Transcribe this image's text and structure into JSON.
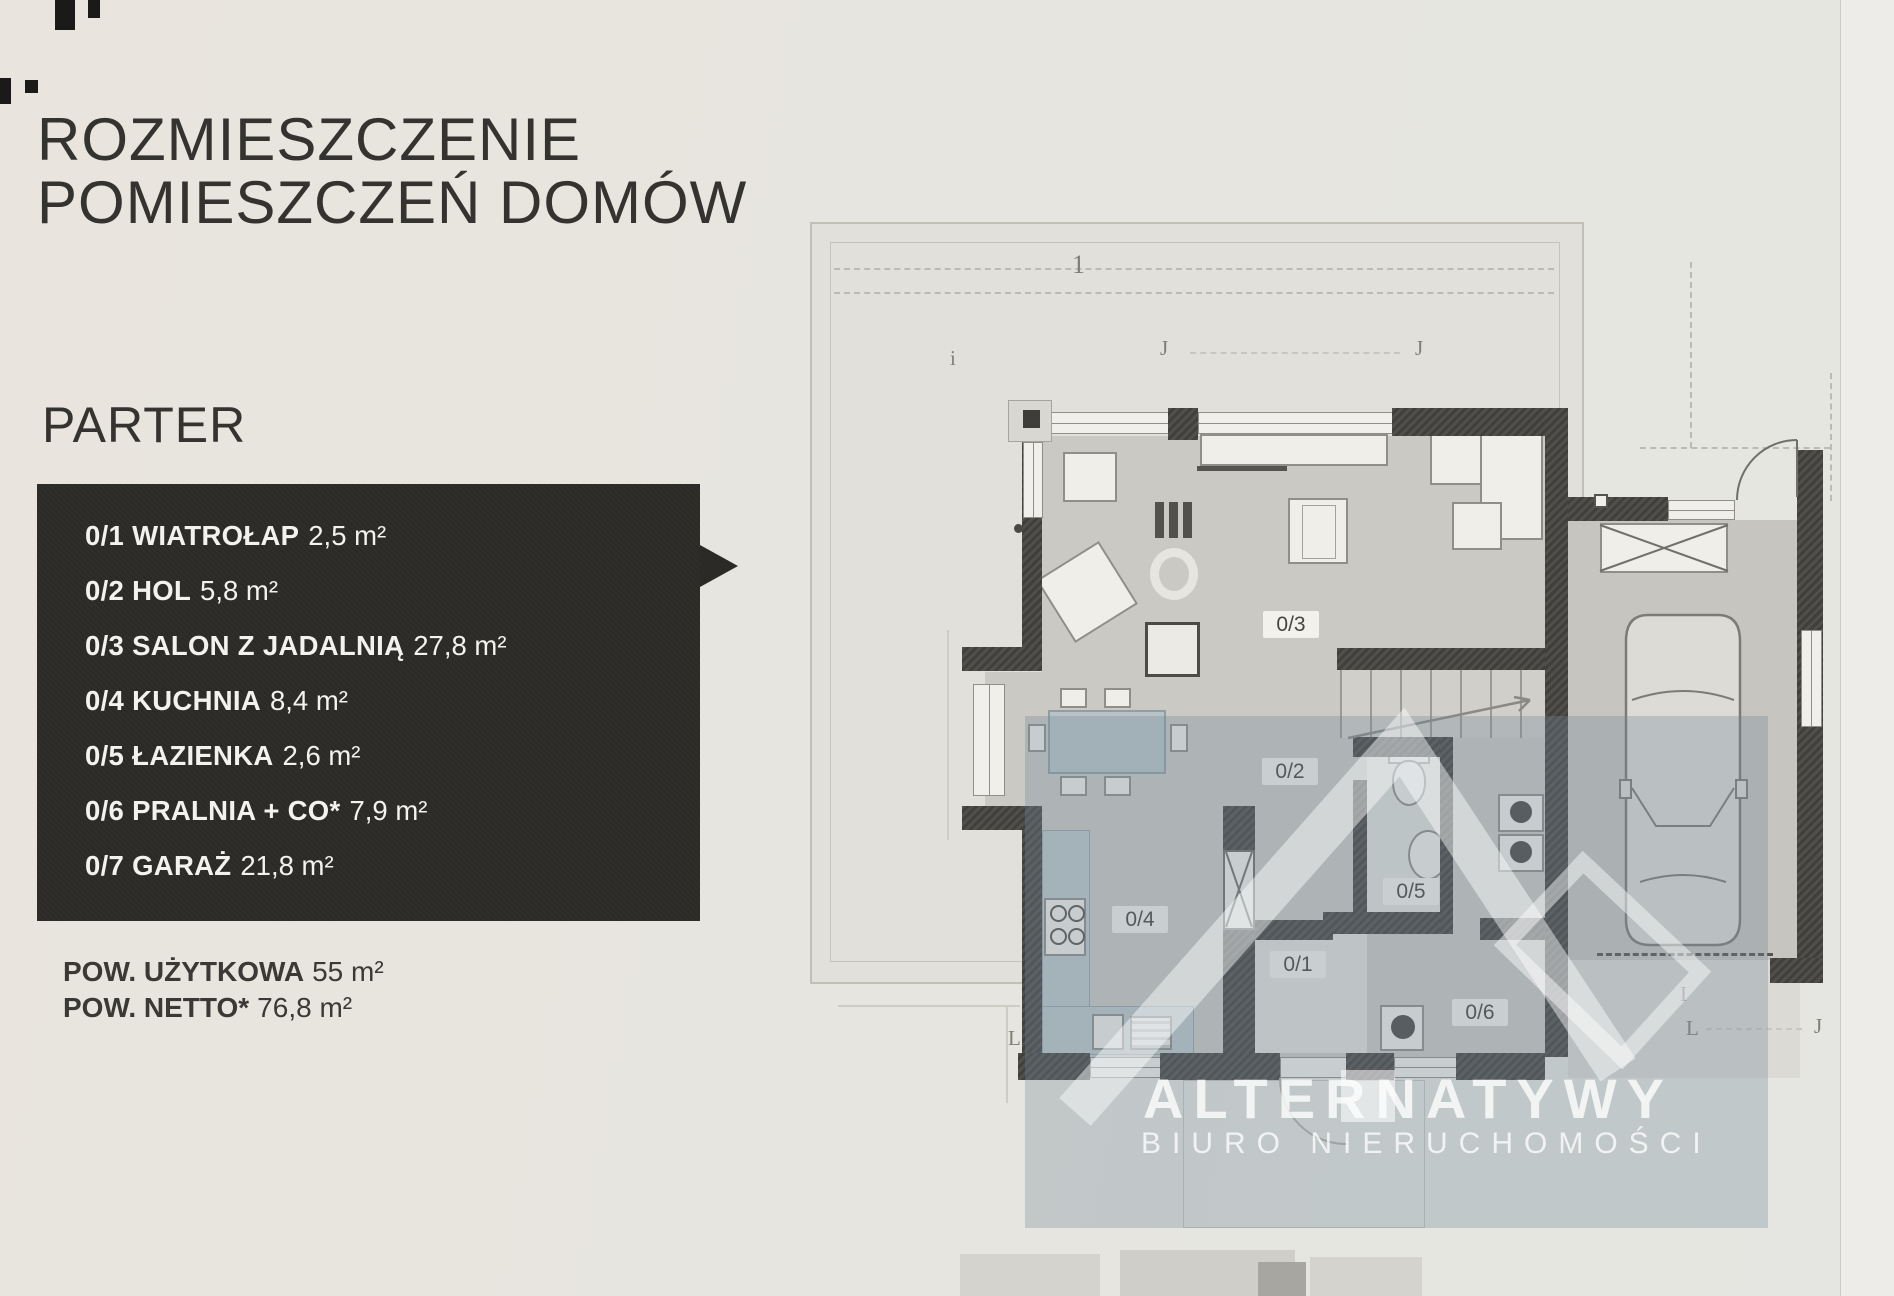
{
  "colors": {
    "ink": "#34332f",
    "box-bg": "#2b2a27",
    "box-text": "#f3f2ef",
    "wall-dark": "#454440",
    "floor-gray": "#cac9c4",
    "tint": "rgba(116,138,152,0.32)",
    "chip-bg": "#f2f1ec"
  },
  "header": {
    "title_line1": "ROZMIESZCZENIE",
    "title_line2": "POMIESZCZEŃ DOMÓW",
    "section": "PARTER"
  },
  "legend": {
    "rooms": [
      {
        "code": "0/1",
        "name": "WIATROŁAP",
        "area": "2,5 m²"
      },
      {
        "code": "0/2",
        "name": "HOL",
        "area": "5,8 m²"
      },
      {
        "code": "0/3",
        "name": "SALON Z JADALNIĄ",
        "area": "27,8 m²"
      },
      {
        "code": "0/4",
        "name": "KUCHNIA",
        "area": "8,4 m²"
      },
      {
        "code": "0/5",
        "name": "ŁAZIENKA",
        "area": "2,6 m²"
      },
      {
        "code": "0/6",
        "name": "PRALNIA + CO*",
        "area": "7,9 m²"
      },
      {
        "code": "0/7",
        "name": "GARAŻ",
        "area": "21,8 m²"
      }
    ]
  },
  "summary": {
    "rows": [
      {
        "label": "POW. UŻYTKOWA",
        "value": "55 m²"
      },
      {
        "label": "POW. NETTO*",
        "value": "76,8 m²"
      }
    ]
  },
  "floorplan": {
    "room_labels": [
      {
        "code": "0/1"
      },
      {
        "code": "0/2"
      },
      {
        "code": "0/3"
      },
      {
        "code": "0/4"
      },
      {
        "code": "0/5"
      },
      {
        "code": "0/6"
      },
      {
        "code": "0/7"
      }
    ],
    "axis_marks": [
      {
        "t": "1"
      },
      {
        "t": "J"
      },
      {
        "t": "J"
      },
      {
        "t": "i"
      },
      {
        "t": "L"
      },
      {
        "t": "I"
      },
      {
        "t": "L"
      },
      {
        "t": "J"
      }
    ]
  },
  "watermark": {
    "brand": "ALTERNATYWY",
    "subtitle": "BIURO NIERUCHOMOŚCI"
  }
}
